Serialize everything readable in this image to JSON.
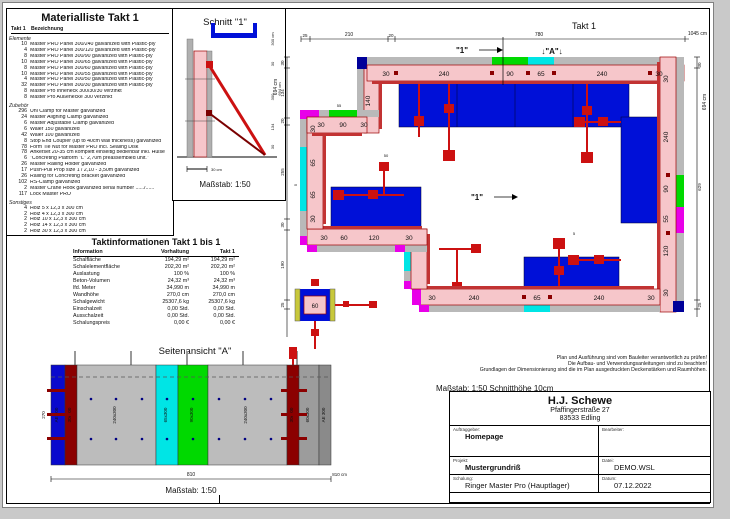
{
  "material_list": {
    "title": "Materialliste  Takt 1",
    "col_qty": "Takt 1",
    "col_desc": "Bezeichnung",
    "sections": [
      {
        "name": "Elemente",
        "items": [
          {
            "qty": "10",
            "desc": "Master PRO Panel 300/240 galvanized with Plastic-ply"
          },
          {
            "qty": "4",
            "desc": "Master PRO Panel 300/120 galvanized with Plastic-ply"
          },
          {
            "qty": "8",
            "desc": "Master PRO Panel 300/90 galvanized with Plastic-ply"
          },
          {
            "qty": "10",
            "desc": "Master PRO Panel 300/65 galvanized with Plastic-ply"
          },
          {
            "qty": "8",
            "desc": "Master PRO Panel 300/60 galvanized with Plastic-ply"
          },
          {
            "qty": "10",
            "desc": "Master PRO Panel 300/55 galvanized with Plastic-ply"
          },
          {
            "qty": "4",
            "desc": "Master PRO Panel 300/50 galvanized with Plastic-ply"
          },
          {
            "qty": "32",
            "desc": "Master PRO Panel 300/30 galvanized with Plastic-ply"
          },
          {
            "qty": "8",
            "desc": "Master Pro Inneneck 300/30/30 verzinkt"
          },
          {
            "qty": "8",
            "desc": "Master Pro Außenecke 300 verzinkt"
          }
        ]
      },
      {
        "name": "Zubehör",
        "items": [
          {
            "qty": "296",
            "desc": "Uni Clamp for Master galvanized"
          },
          {
            "qty": "24",
            "desc": "Master Aligning Clamp galvanized"
          },
          {
            "qty": "6",
            "desc": "Master Adjustable Clamp galvanized"
          },
          {
            "qty": "6",
            "desc": "Waler 150 galvanized"
          },
          {
            "qty": "42",
            "desc": "Waler 100 galvanized"
          },
          {
            "qty": "8",
            "desc": "Stop End Coupler (up to 40cm wall thickness) galvanized"
          },
          {
            "qty": "78",
            "desc": "Form Tie Nut for Master PRO incl. Sealing Disk"
          },
          {
            "qty": "78",
            "desc": "Ankerset 20-35 cm komplett einseitig bedienbar inkl. Hülse"
          },
          {
            "qty": "6",
            "desc": "\"Concreting Platform \"L\" 2,70m preassembled unit.\""
          },
          {
            "qty": "26",
            "desc": "Master Railing Holder galvanized"
          },
          {
            "qty": "17",
            "desc": "Push-Pull Prop size 1 / 2,10 - 3,50m galvanized"
          },
          {
            "qty": "26",
            "desc": "Railing for Concreting Bracket galvanized"
          },
          {
            "qty": "102",
            "desc": "RS-Clamp galvanized"
          },
          {
            "qty": "2",
            "desc": "Master Crane Hook galvanized serial number ....../......"
          },
          {
            "qty": "117",
            "desc": "Lock Master PRO"
          }
        ]
      },
      {
        "name": "Sonstiges",
        "items": [
          {
            "qty": "4",
            "desc": "Holz 5 x 12,3 x 300 cm"
          },
          {
            "qty": "2",
            "desc": "Holz 4 x 12,3 x 300 cm"
          },
          {
            "qty": "2",
            "desc": "Holz 10 x 12,3 x 300 cm"
          },
          {
            "qty": "2",
            "desc": "Holz 14 x 12,3 x 300 cm"
          },
          {
            "qty": "2",
            "desc": "Holz 30 x 12,3 x 300 cm"
          }
        ]
      }
    ]
  },
  "schnitt": {
    "title": "Schnitt \"1\"",
    "dims": [
      "300 cm",
      "30",
      "300",
      "134",
      "30"
    ],
    "total": "694 cm",
    "bar": "30 cm",
    "scale": "Maßstab: 1:50"
  },
  "takt_info": {
    "title": "Taktinformationen  Takt 1 bis 1",
    "headers": [
      "Information",
      "Vorhaltung",
      "Takt 1"
    ],
    "rows": [
      [
        "Schalfläche",
        "194,29 m²",
        "194,29 m²"
      ],
      [
        "Schalelementfläche",
        "202,20 m²",
        "202,20 m²"
      ],
      [
        "Auslastung",
        "100 %",
        "100 %"
      ],
      [
        "Beton-Volumen",
        "24,32 m³",
        "24,32 m³"
      ],
      [
        "lfd. Meter",
        "34,990 m",
        "34,990 m"
      ],
      [
        "Wandhöhe",
        "270,0 cm",
        "270,0 cm"
      ],
      [
        "Schalgewicht",
        "25307,6 kg",
        "25307,6 kg"
      ],
      [
        "Einschalzeit",
        "0,00 Std.",
        "0,00 Std."
      ],
      [
        "Ausschalzeit",
        "0,00 Std.",
        "0,00 Std."
      ],
      [
        "Schalungspreis",
        "0,00 €",
        "0,00 €"
      ]
    ]
  },
  "side_view": {
    "title": "Seitenansicht \"A\"",
    "scale": "Maßstab: 1:50",
    "dim": "810",
    "dim_right": "810 cm",
    "height_dim": "270",
    "panels": [
      {
        "label": "AE 300",
        "color": "#0a0acd"
      },
      {
        "label": "30x300",
        "color": "#8b0000"
      },
      {
        "label": "240x300",
        "color": "#bcbcbc"
      },
      {
        "label": "65x300",
        "color": "#00e5e5"
      },
      {
        "label": "90x300",
        "color": "#00d900"
      },
      {
        "label": "240x300",
        "color": "#bcbcbc"
      },
      {
        "label": "30x300",
        "color": "#8b0000"
      },
      {
        "label": "60x300",
        "color": "#9c9c9c"
      },
      {
        "label": "AE 300",
        "color": "#8a8a8a"
      }
    ]
  },
  "plan": {
    "title": "Takt 1",
    "marker_1": "\"1\"",
    "marker_a": "↓\"A\"↓",
    "marker_1_inner": "\"1\"",
    "scale_note": "Maßstab: 1:50   Schnitthöhe 10cm",
    "top_dims": [
      "25",
      "210",
      "20",
      "780"
    ],
    "top_total": "1045 cm",
    "left_dims": [
      "30",
      "134",
      "20",
      "255",
      "30",
      "190",
      "25"
    ],
    "left_total": "694 cm",
    "right_dims": [
      "30",
      "629",
      "25"
    ],
    "right_total": "694 cm",
    "top_wall": [
      "30",
      "240",
      "90",
      "65",
      "240",
      "30"
    ],
    "right_wall": [
      "30",
      "240",
      "90",
      "55",
      "120",
      "30"
    ],
    "bottom_wall": [
      "30",
      "240",
      "65",
      "240",
      "30"
    ],
    "mid_wall": [
      "30",
      "60",
      "120",
      "30"
    ],
    "left_wall": [
      "30",
      "65",
      "65",
      "30"
    ],
    "upleft_wall": [
      "30",
      "90",
      "30"
    ],
    "jog_dim": "140",
    "block_label": "60",
    "misc_dims": [
      "55",
      "50",
      "5",
      "5"
    ]
  },
  "notes": {
    "lines": [
      "Plan und Ausführung sind vom Bauleiter verantwortlich zu prüfen!",
      "Die Aufbau- und Verwendungsanleitungen sind zu beachten!",
      "Grundlagen der Dimensionierung sind die im Plan ausgedruckten Deckenstärken und Raumhöhen."
    ]
  },
  "title_block": {
    "company": "H.J. Schewe",
    "address1": "Pfaffingerstraße 27",
    "address2": "83533 Edling",
    "labels": {
      "auftraggeber": "Auftraggeber:",
      "bearbeiter": "Bearbeiter:",
      "projekt": "Projekt:",
      "datei": "Datei:",
      "schalung": "Schalung:",
      "datum": "Datum:"
    },
    "values": {
      "auftraggeber": "Homepage",
      "bearbeiter": "",
      "projekt": "Mustergrundriß",
      "datei": "DEMO.WSL",
      "schalung": "Ringer Master Pro (Hauptlager)",
      "datum": "07.12.2022"
    }
  },
  "colors": {
    "wall_concrete": "#f6c6ca",
    "panel_gray": "#b9b9b9",
    "prop_red": "#cc1111",
    "frame_dark_red": "#8b0000",
    "platform_blue": "#0010d8",
    "panel_90_green": "#00d900",
    "panel_65_cyan": "#00e5e5",
    "panel_55_magenta": "#e800e8",
    "corner_blue": "#000099",
    "waler_yellow": "#c8c83c"
  }
}
